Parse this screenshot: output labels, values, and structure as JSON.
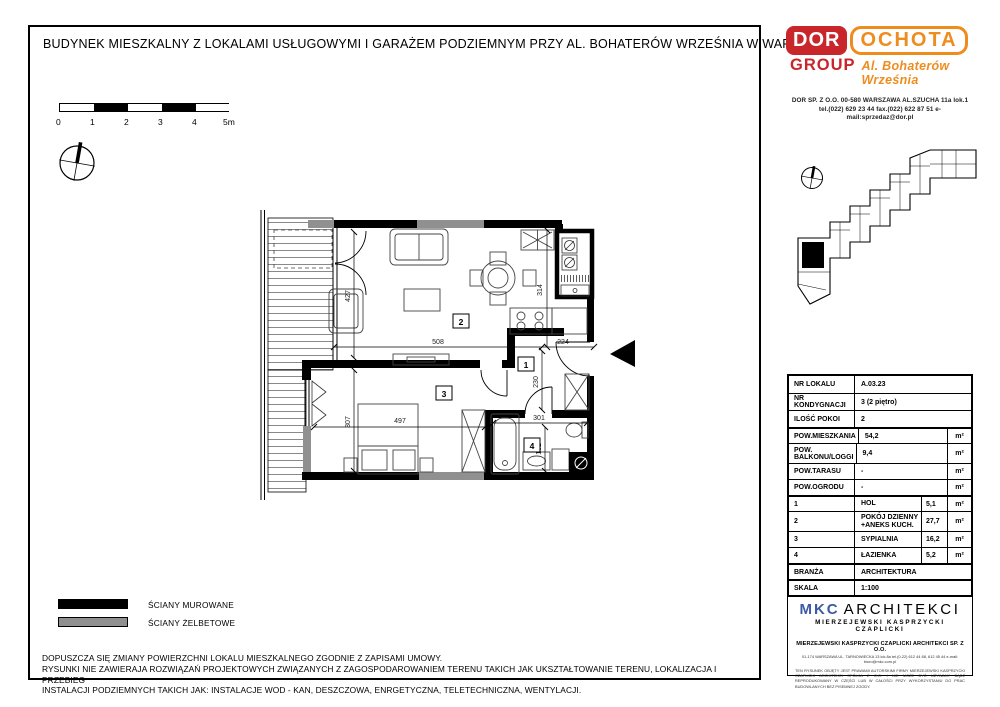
{
  "sheet": {
    "title": "BUDYNEK MIESZKALNY Z LOKALAMI USŁUGOWYMI I GARAŻEM PODZIEMNYM PRZY AL. BOHATERÓW WRZEŚNIA W WARSZAWIE"
  },
  "developer": {
    "brand1": "DOR",
    "brand2": "OCHOTA",
    "brand3": "GROUP",
    "brand4": "Al. Bohaterów Września",
    "address": "DOR SP. Z O.O.   00-580  WARSZAWA  AL.SZUCHA 11a lok.1",
    "contact": "tel.(022) 629 23 44   fax.(022) 622 87 51   e-mail:sprzedaz@dor.pl"
  },
  "scale_bar": {
    "labels": [
      "0",
      "1",
      "2",
      "3",
      "4",
      "5m"
    ]
  },
  "floor_plan": {
    "room_numbers": {
      "hall": "1",
      "living": "2",
      "bedroom": "3",
      "bathroom": "4"
    },
    "dims": {
      "d508": "508",
      "d224": "224",
      "d314": "314",
      "d427": "427",
      "d230": "230",
      "d301": "301",
      "d182": "182",
      "d497": "497",
      "d307": "307"
    }
  },
  "unit_table": {
    "info_rows": [
      {
        "label": "NR LOKALU",
        "value": "A.03.23"
      },
      {
        "label": "NR KONDYGNACJI",
        "value": "3 (2 piętro)"
      },
      {
        "label": "ILOŚĆ POKOI",
        "value": "2"
      }
    ],
    "area_rows": [
      {
        "label": "POW.MIESZKANIA",
        "value": "54,2",
        "unit": "m²"
      },
      {
        "label": "POW. BALKONU/LOGGI",
        "value": "9,4",
        "unit": "m²"
      },
      {
        "label": "POW.TARASU",
        "value": "-",
        "unit": "m²"
      },
      {
        "label": "POW.OGRODU",
        "value": "-",
        "unit": "m²"
      }
    ],
    "room_rows": [
      {
        "no": "1",
        "name": "HOL",
        "value": "5,1",
        "unit": "m²"
      },
      {
        "no": "2",
        "name": "POKÓJ DZIENNY +ANEKS KUCH.",
        "value": "27,7",
        "unit": "m²"
      },
      {
        "no": "3",
        "name": "SYPIALNIA",
        "value": "16,2",
        "unit": "m²"
      },
      {
        "no": "4",
        "name": "ŁAZIENKA",
        "value": "5,2",
        "unit": "m²"
      }
    ],
    "meta_rows": [
      {
        "label": "BRANŻA",
        "value": "ARCHITEKTURA"
      },
      {
        "label": "SKALA",
        "value": "1:100"
      }
    ]
  },
  "legend": {
    "masonry": "ŚCIANY MUROWANE",
    "concrete": "ŚCIANY ŻELBETOWE"
  },
  "notes": {
    "line1": "DOPUSZCZA SIĘ ZMIANY POWIERZCHNI LOKALU MIESZKALNEGO ZGODNIE Z ZAPISAMI UMOWY.",
    "line2": "RYSUNKI NIE ZAWIERAJA ROZWIĄZAŃ PROJEKTOWYCH ZWIĄZANYCH Z ZAGOSPODAROWANIEM TERENU TAKICH JAK UKSZTAŁTOWANIE TERENU, LOKALIZACJA I PRZEBIEG",
    "line3": "INSTALACJI PODZIEMNYCH TAKICH JAK: INSTALACJE WOD - KAN, DESZCZOWA, ENRGETYCZNA, TELETECHNICZNA, WENTYLACJI."
  },
  "architect": {
    "logo1": "MKC",
    "logo2": "ARCHITEKCI",
    "logo3": "MIERZEJEWSKI KASPRZYCKI CZAPLICKI",
    "firm": "MIERZEJEWSKI KASPRZYCKI CZAPLICKI ARCHITEKCI SP. Z O.O.",
    "firm_address": "01-174 WARSZAWA UL. TARNOWIECKA 13 lok.8a  tel.(0-22) 612 44 88, 612 45 44  e-mail: biuro@mkc.com.pl",
    "copyright": "TEN RYSUNEK OBJĘTY JEST PRAWAMI AUTORSKIMI FIRMY MIERZEJEWSKI KASPRZYCKI CZAPLICKI ARCHITEKCI SPÓŁKA Z O.O. I NIE MOŻE BYĆ UŻYWANY BĄDŹ REPRODUKOWANY W CZĘŚCI LUB W CAŁOŚCI PRZY WYKORZYSTANIU DO PRAC BUDOWLANYCH BEZ PISEMNEJ ZGODY."
  },
  "colors": {
    "brand_red": "#c9262c",
    "brand_orange": "#ee8c1e",
    "architect_blue": "#3b5ba5",
    "concrete_grey": "#909090"
  }
}
